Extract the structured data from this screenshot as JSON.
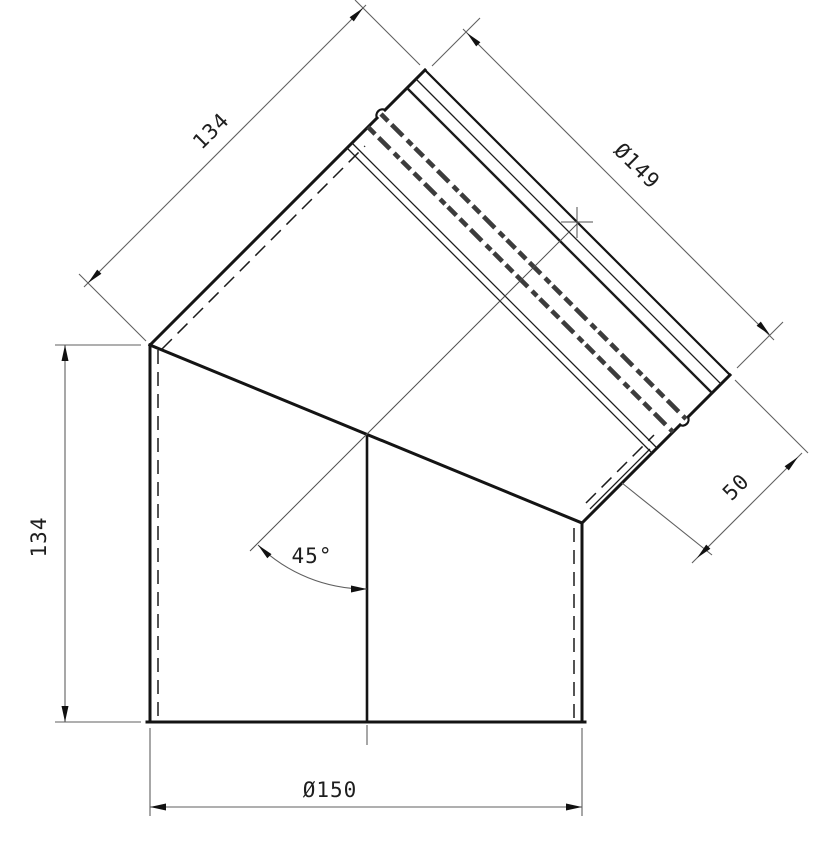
{
  "drawing": {
    "title": "45-degree flue pipe elbow - dimensioned profile drawing",
    "background_color": "#ffffff",
    "outline_color": "#141414",
    "dimension_color": "#5f5f5f",
    "text_color": "#1e1e1e"
  },
  "dimensions": {
    "upper_length": {
      "label": "134"
    },
    "spigot_diameter": {
      "label": "Ø149"
    },
    "spigot_depth": {
      "label": "50"
    },
    "lower_length": {
      "label": "134"
    },
    "bend_angle": {
      "label": "45°"
    },
    "body_diameter": {
      "label": "Ø150"
    }
  }
}
